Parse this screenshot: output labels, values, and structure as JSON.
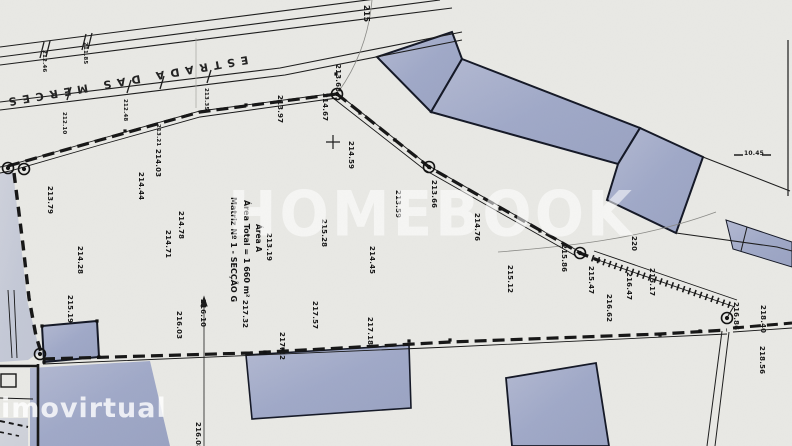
{
  "meta": {
    "paper_color": "#e9e9e5",
    "ink_color": "#1c1c1c",
    "building_fill": "#a6adc9",
    "watermark_color": "#ffffff"
  },
  "watermarks": {
    "center": "HOMEBOOK",
    "corner": "imovirtual"
  },
  "street": {
    "name": "ESTRADA DAS MERCES"
  },
  "parcel": {
    "matriz_line": "Matriz Nº 1 - SECÇÃO G",
    "area_total_line": "Área Total = 1 660 m²",
    "area_a_label": "Área A"
  },
  "labels": [
    {
      "t": "212.46",
      "x": 46,
      "y": 50,
      "s": 5.5
    },
    {
      "t": "211.85",
      "x": 87,
      "y": 42,
      "s": 5.5
    },
    {
      "t": "212.10",
      "x": 66,
      "y": 112,
      "s": 5.5
    },
    {
      "t": "212.48",
      "x": 127,
      "y": 99,
      "s": 5.5
    },
    {
      "t": "213.21",
      "x": 160,
      "y": 124,
      "s": 5.5
    },
    {
      "t": "213.35",
      "x": 208,
      "y": 88,
      "s": 5.5
    },
    {
      "t": "213.79",
      "x": 53,
      "y": 186,
      "s": 7
    },
    {
      "t": "214.44",
      "x": 144,
      "y": 172,
      "s": 7
    },
    {
      "t": "214.03",
      "x": 161,
      "y": 149,
      "s": 7
    },
    {
      "t": "214.78",
      "x": 184,
      "y": 211,
      "s": 7
    },
    {
      "t": "214.71",
      "x": 171,
      "y": 230,
      "s": 7
    },
    {
      "t": "214.28",
      "x": 83,
      "y": 246,
      "s": 7
    },
    {
      "t": "215.19",
      "x": 73,
      "y": 295,
      "s": 7
    },
    {
      "t": "216.03",
      "x": 182,
      "y": 311,
      "s": 7
    },
    {
      "t": "213.19",
      "x": 272,
      "y": 233,
      "s": 7
    },
    {
      "t": "215.28",
      "x": 327,
      "y": 219,
      "s": 7
    },
    {
      "t": "214.59",
      "x": 354,
      "y": 141,
      "s": 7
    },
    {
      "t": "213.68",
      "x": 341,
      "y": 64,
      "s": 7
    },
    {
      "t": "214.67",
      "x": 328,
      "y": 93,
      "s": 7
    },
    {
      "t": "213.97",
      "x": 283,
      "y": 95,
      "s": 7
    },
    {
      "t": "213.59",
      "x": 401,
      "y": 190,
      "s": 7
    },
    {
      "t": "214.45",
      "x": 375,
      "y": 246,
      "s": 7
    },
    {
      "t": "213.66",
      "x": 437,
      "y": 180,
      "s": 7
    },
    {
      "t": "214.76",
      "x": 480,
      "y": 213,
      "s": 7
    },
    {
      "t": "215.12",
      "x": 513,
      "y": 265,
      "s": 7
    },
    {
      "t": "215.86",
      "x": 567,
      "y": 244,
      "s": 7
    },
    {
      "t": "215.47",
      "x": 594,
      "y": 266,
      "s": 7
    },
    {
      "t": "216.47",
      "x": 632,
      "y": 272,
      "s": 7
    },
    {
      "t": "216.62",
      "x": 612,
      "y": 294,
      "s": 7
    },
    {
      "t": "215.17",
      "x": 655,
      "y": 268,
      "s": 7
    },
    {
      "t": "216.86",
      "x": 739,
      "y": 302,
      "s": 7
    },
    {
      "t": "218.40",
      "x": 766,
      "y": 305,
      "s": 7
    },
    {
      "t": "218.56",
      "x": 765,
      "y": 346,
      "s": 7
    },
    {
      "t": "217.32",
      "x": 248,
      "y": 300,
      "s": 7
    },
    {
      "t": "217.57",
      "x": 318,
      "y": 301,
      "s": 7
    },
    {
      "t": "217.18",
      "x": 373,
      "y": 317,
      "s": 7
    },
    {
      "t": "217.12",
      "x": 285,
      "y": 332,
      "s": 7
    },
    {
      "t": "216.10",
      "x": 206,
      "y": 299,
      "s": 7
    },
    {
      "t": "216.08",
      "x": 201,
      "y": 422,
      "s": 7
    },
    {
      "t": "215",
      "x": 370,
      "y": 5,
      "s": 8
    },
    {
      "t": "220",
      "x": 637,
      "y": 236,
      "s": 7
    },
    {
      "t": "10.45",
      "x": 744,
      "y": 151,
      "s": 6,
      "r": 0
    }
  ]
}
